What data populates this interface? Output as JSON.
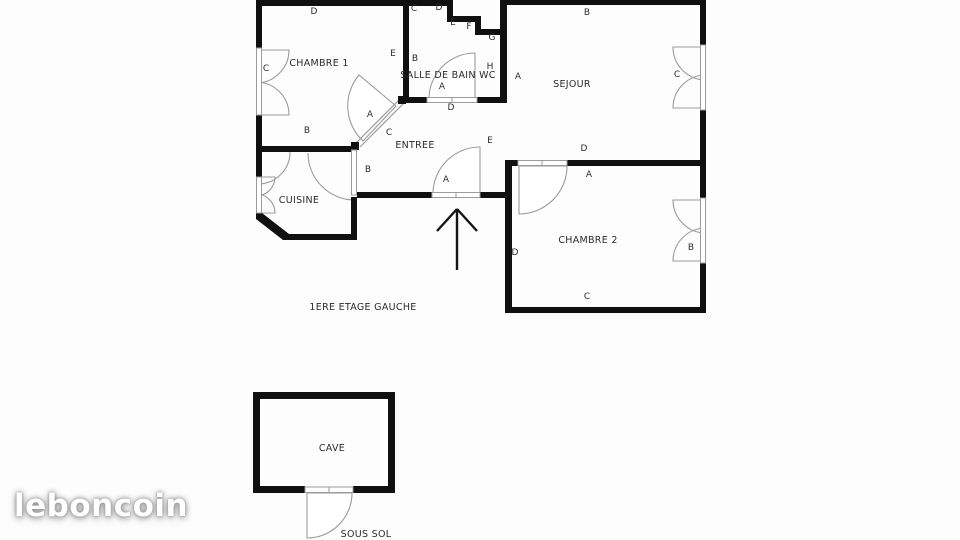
{
  "watermark": {
    "brand": "leboncoin"
  },
  "plan": {
    "floor_caption": "1ERE ETAGE GAUCHE",
    "basement_caption": "SOUS SOL",
    "rooms": {
      "chambre1": "CHAMBRE 1",
      "salle_de_bain_wc": "SALLE DE BAIN WC",
      "sejour": "SEJOUR",
      "entree": "ENTREE",
      "cuisine": "CUISINE",
      "chambre2": "CHAMBRE 2",
      "cave": "CAVE"
    },
    "markers": [
      "D",
      "C",
      "E",
      "A",
      "B",
      "C",
      "C",
      "D",
      "E",
      "F",
      "G",
      "B",
      "A",
      "H",
      "D",
      "A",
      "B",
      "C",
      "D",
      "E",
      "B",
      "A",
      "A",
      "D",
      "B",
      "C"
    ],
    "colors": {
      "wall": "#101010",
      "thin_line": "#9b9b9b",
      "background": "#fdfdfd",
      "watermark": "#ffffff"
    }
  }
}
